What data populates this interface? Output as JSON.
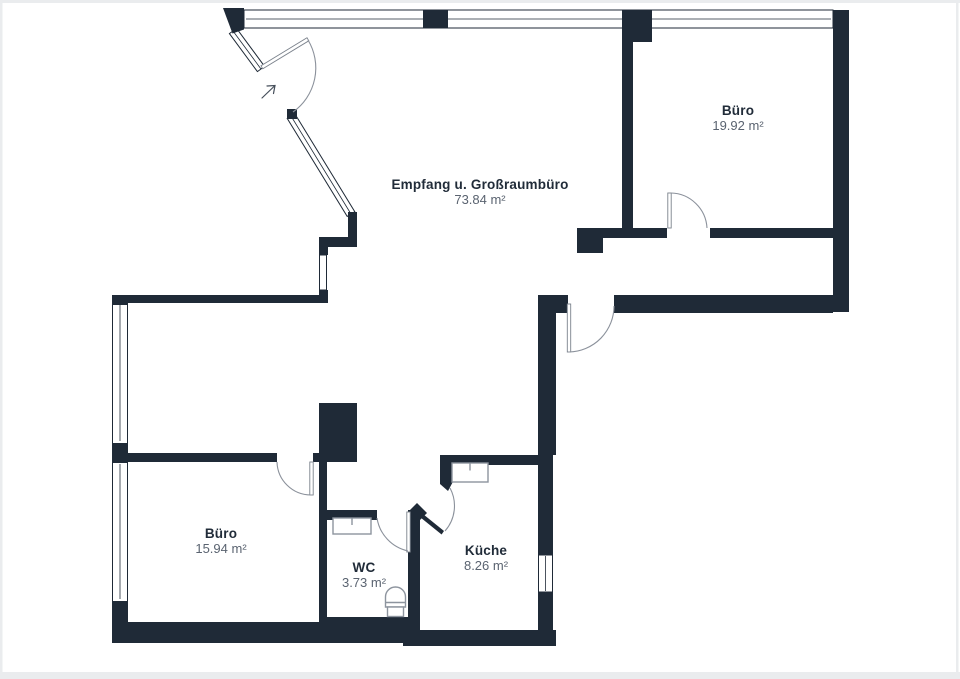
{
  "floorplan": {
    "title": "Floor plan",
    "rooms": [
      {
        "id": "buero-top",
        "name": "Büro",
        "area": "19.92 m²"
      },
      {
        "id": "empfang",
        "name": "Empfang u. Großraumbüro",
        "area": "73.84 m²"
      },
      {
        "id": "buero-bottom",
        "name": "Büro",
        "area": "15.94 m²"
      },
      {
        "id": "wc",
        "name": "WC",
        "area": "3.73 m²"
      },
      {
        "id": "kueche",
        "name": "Küche",
        "area": "8.26 m²"
      }
    ],
    "colors": {
      "wall": "#1f2a37",
      "label": "#212c39",
      "area": "#5a6370",
      "door_leaf": "#7b828c",
      "door_arc": "#8b919b",
      "fixture": "#8d949e",
      "arrow": "#454e5a",
      "page_edge": "#eaecee"
    },
    "symbols": {
      "entrance_arrow": "up-right",
      "fixtures": [
        "wc-sink",
        "toilet",
        "kitchen-sink"
      ]
    }
  }
}
